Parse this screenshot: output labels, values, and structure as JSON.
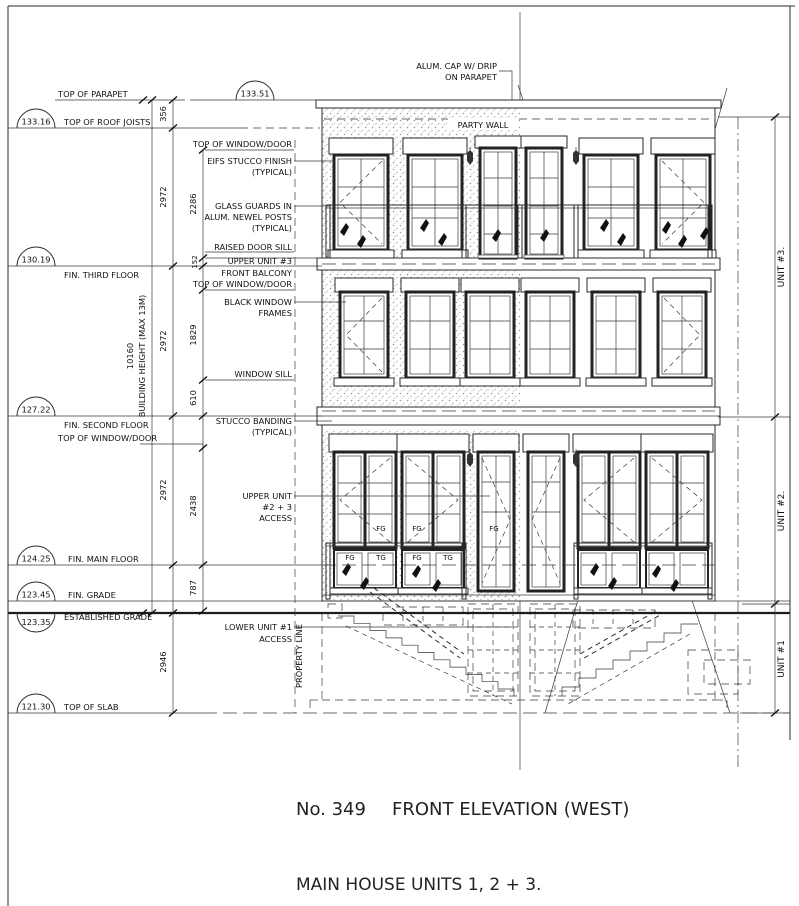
{
  "drawing": {
    "number": "No. 349",
    "title": "FRONT ELEVATION (WEST)",
    "subtitle": "MAIN HOUSE  UNITS 1, 2 + 3."
  },
  "levels": {
    "parapet": {
      "label": "TOP OF PARAPET",
      "value": "133.51"
    },
    "roof_joists": {
      "label": "TOP OF ROOF JOISTS",
      "value": "133.16"
    },
    "third_floor": {
      "label": "FIN. THIRD FLOOR",
      "value": "130.19"
    },
    "second_floor": {
      "label": "FIN. SECOND FLOOR",
      "value": "127.22"
    },
    "main_floor": {
      "label": "FIN. MAIN FLOOR",
      "value": "124.25"
    },
    "fin_grade": {
      "label": "FIN. GRADE",
      "value": "123.45"
    },
    "established_grade": {
      "label": "ESTABLISHED GRADE",
      "value": "123.35"
    },
    "top_of_slab": {
      "label": "TOP OF SLAB",
      "value": "121.30"
    }
  },
  "dimensions": {
    "parapet": "356",
    "floor_height": "2972",
    "window_head_third": "2286",
    "raised_sill": "152",
    "window_head_second": "1829",
    "sill_second": "610",
    "window_head_main": "2438",
    "main_to_grade": "787",
    "grade_to_slab": "2946",
    "building_height": "10160",
    "building_height_note": "BUILDING HEIGHT (MAX 13M)"
  },
  "annotations": {
    "alum_cap_1": "ALUM. CAP W/ DRIP",
    "alum_cap_2": "ON PARAPET",
    "party_wall": "PARTY WALL",
    "top_of_window_door": "TOP OF WINDOW/DOOR",
    "eifs_1": "EIFS STUCCO FINISH",
    "typical": "(TYPICAL)",
    "glass_guards_1": "GLASS GUARDS IN",
    "glass_guards_2": "ALUM. NEWEL POSTS",
    "raised_door_sill": "RAISED DOOR SILL",
    "upper_unit_3": "UPPER UNIT #3",
    "front_balcony": "FRONT BALCONY",
    "black_window_1": "BLACK WINDOW",
    "black_window_2": "FRAMES",
    "window_sill": "WINDOW SILL",
    "stucco_banding_1": "STUCCO BANDING",
    "upper_access_1": "UPPER UNIT",
    "upper_access_2": "#2 + 3",
    "upper_access_3": "ACCESS",
    "lower_access_1": "LOWER UNIT #1",
    "lower_access_2": "ACCESS",
    "property_line": "PROPERTY LINE"
  },
  "units": {
    "unit3": "UNIT #3.",
    "unit2": "UNIT #2.",
    "unit1": "UNIT #1"
  },
  "glazing_labels": [
    "FG",
    "TG"
  ]
}
